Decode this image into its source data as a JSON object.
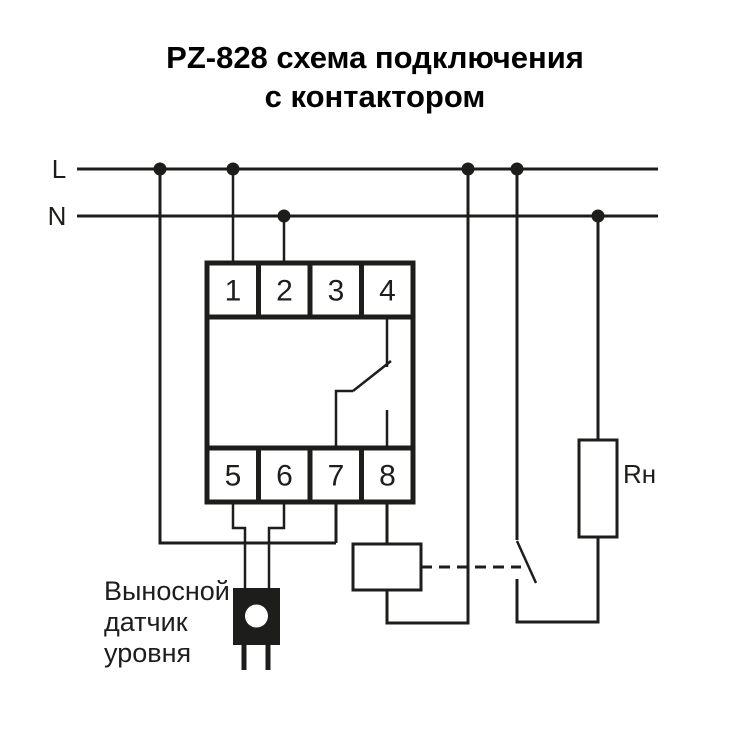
{
  "title": {
    "line1": "PZ-828 схема подключения",
    "line2": "с контактором"
  },
  "bus": {
    "l_label": "L",
    "n_label": "N"
  },
  "device": {
    "terminals_top": [
      "1",
      "2",
      "3",
      "4"
    ],
    "terminals_bottom": [
      "5",
      "6",
      "7",
      "8"
    ]
  },
  "load": {
    "label": "Rн"
  },
  "sensor": {
    "label_lines": [
      "Выносной",
      "датчик",
      "уровня"
    ]
  },
  "colors": {
    "background": "#ffffff",
    "line": "#1d1d1b",
    "text": "#000000"
  }
}
